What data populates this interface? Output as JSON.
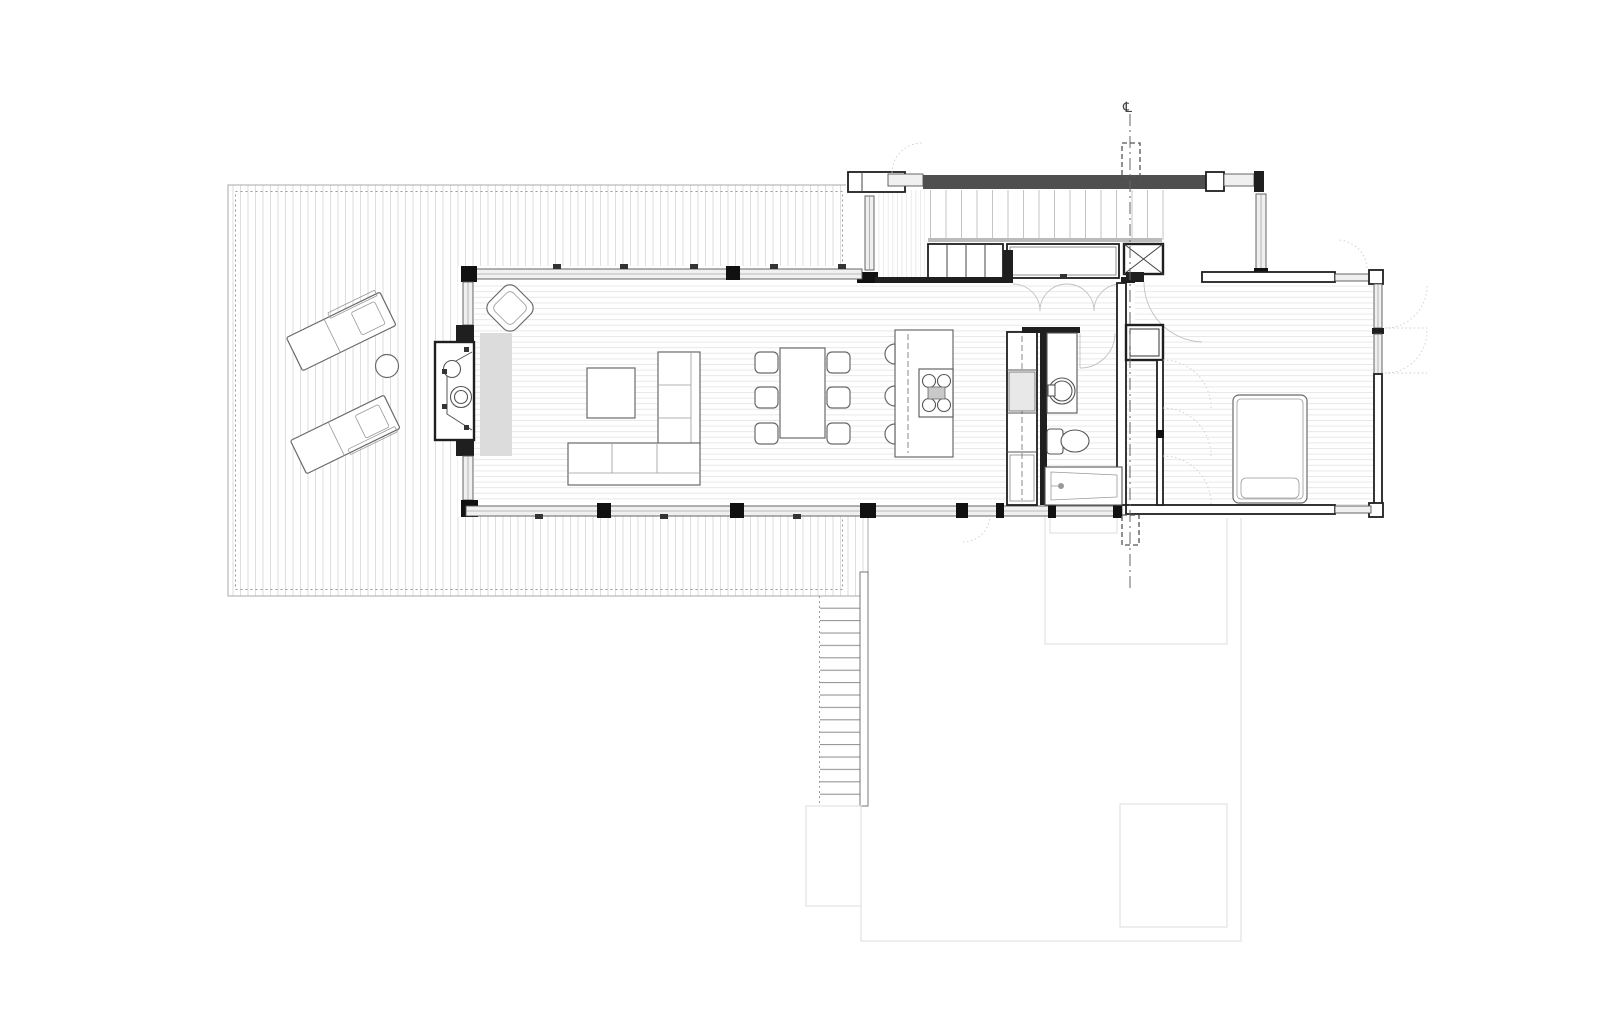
{
  "drawing": {
    "type": "architectural floor plan, main level",
    "centerline_symbol": "℄",
    "background": "#ffffff",
    "colors": {
      "walls": "#1f1f1f",
      "furniture": "#6a6a6a",
      "floor_lines": "#e3e3e3",
      "deck_lines": "#d6d6d6",
      "board_lines": "#bdbdbd",
      "site_lines": "#dcdcdc",
      "hearth_fill": "#dcdcdc",
      "band_fill": "#f0f0f0",
      "dark_band": "#4f4f4f"
    },
    "rooms": [
      {
        "name": "deck-terrace"
      },
      {
        "name": "living-room"
      },
      {
        "name": "dining-area"
      },
      {
        "name": "kitchen"
      },
      {
        "name": "entry-porch"
      },
      {
        "name": "hallway"
      },
      {
        "name": "bathroom"
      },
      {
        "name": "bedroom"
      },
      {
        "name": "wardrobe"
      },
      {
        "name": "storage-closets"
      },
      {
        "name": "exterior-stair"
      },
      {
        "name": "lower-terrace-outline"
      }
    ],
    "fixtures": [
      {
        "name": "lounge-chair",
        "count": 2
      },
      {
        "name": "round-side-table",
        "count": 1
      },
      {
        "name": "outdoor-fireplace",
        "count": 1
      },
      {
        "name": "armchair",
        "count": 1
      },
      {
        "name": "sofa-l-shaped",
        "count": 1
      },
      {
        "name": "coffee-table",
        "count": 1
      },
      {
        "name": "dining-table",
        "count": 1
      },
      {
        "name": "dining-chair",
        "count": 6
      },
      {
        "name": "kitchen-island-with-cooktop",
        "count": 1
      },
      {
        "name": "bar-stool",
        "count": 3
      },
      {
        "name": "tall-cabinet-run",
        "count": 1
      },
      {
        "name": "wash-basin",
        "count": 1
      },
      {
        "name": "toilet",
        "count": 1
      },
      {
        "name": "bathtub",
        "count": 1
      },
      {
        "name": "double-bed",
        "count": 1
      },
      {
        "name": "mechanical-unit-x-box",
        "count": 1
      }
    ],
    "counts": {
      "stair_treads": 17,
      "dining_chairs": 6,
      "bar_stools": 3,
      "lounge_chairs": 2,
      "wardrobe_door_arcs": 3
    }
  }
}
